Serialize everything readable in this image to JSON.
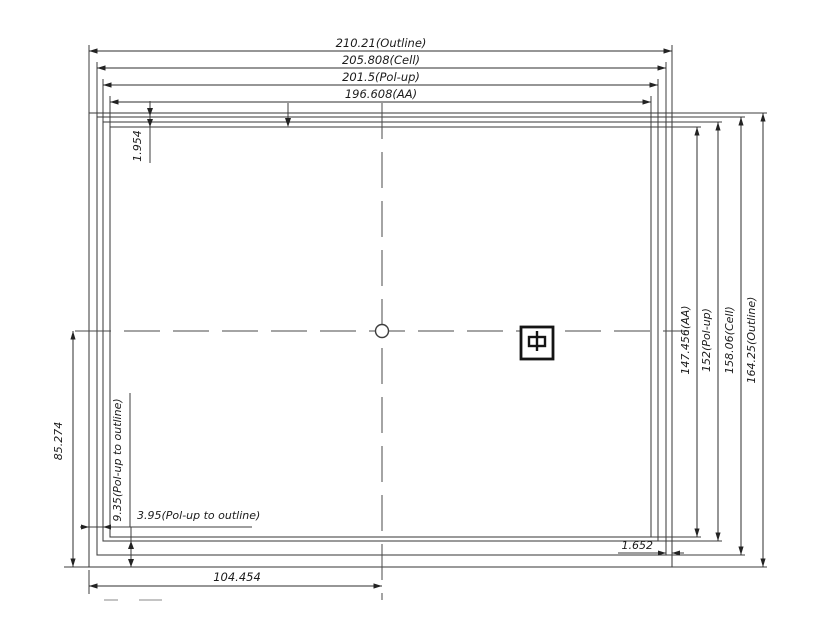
{
  "drawing": {
    "top_dimensions": [
      {
        "label": "210.21(Outline)"
      },
      {
        "label": "205.808(Cell)"
      },
      {
        "label": "201.5(Pol-up)"
      },
      {
        "label": "196.608(AA)"
      }
    ],
    "right_dimensions": [
      {
        "label": "147.456(AA)"
      },
      {
        "label": "152(Pol-up)"
      },
      {
        "label": "158.06(Cell)"
      },
      {
        "label": "164.25(Outline)"
      }
    ],
    "left_dimensions": {
      "center_to_bottom": "85.274",
      "polup_to_outline_side": "9.35(Pol-up to outline)",
      "top_edge_offset": "1.954"
    },
    "bottom_dimensions": {
      "polup_to_outline_bottom": "3.95(Pol-up to outline)",
      "left_to_center": "104.454",
      "right_edge_offset": "1.652"
    },
    "center_mark_glyph": "中"
  }
}
